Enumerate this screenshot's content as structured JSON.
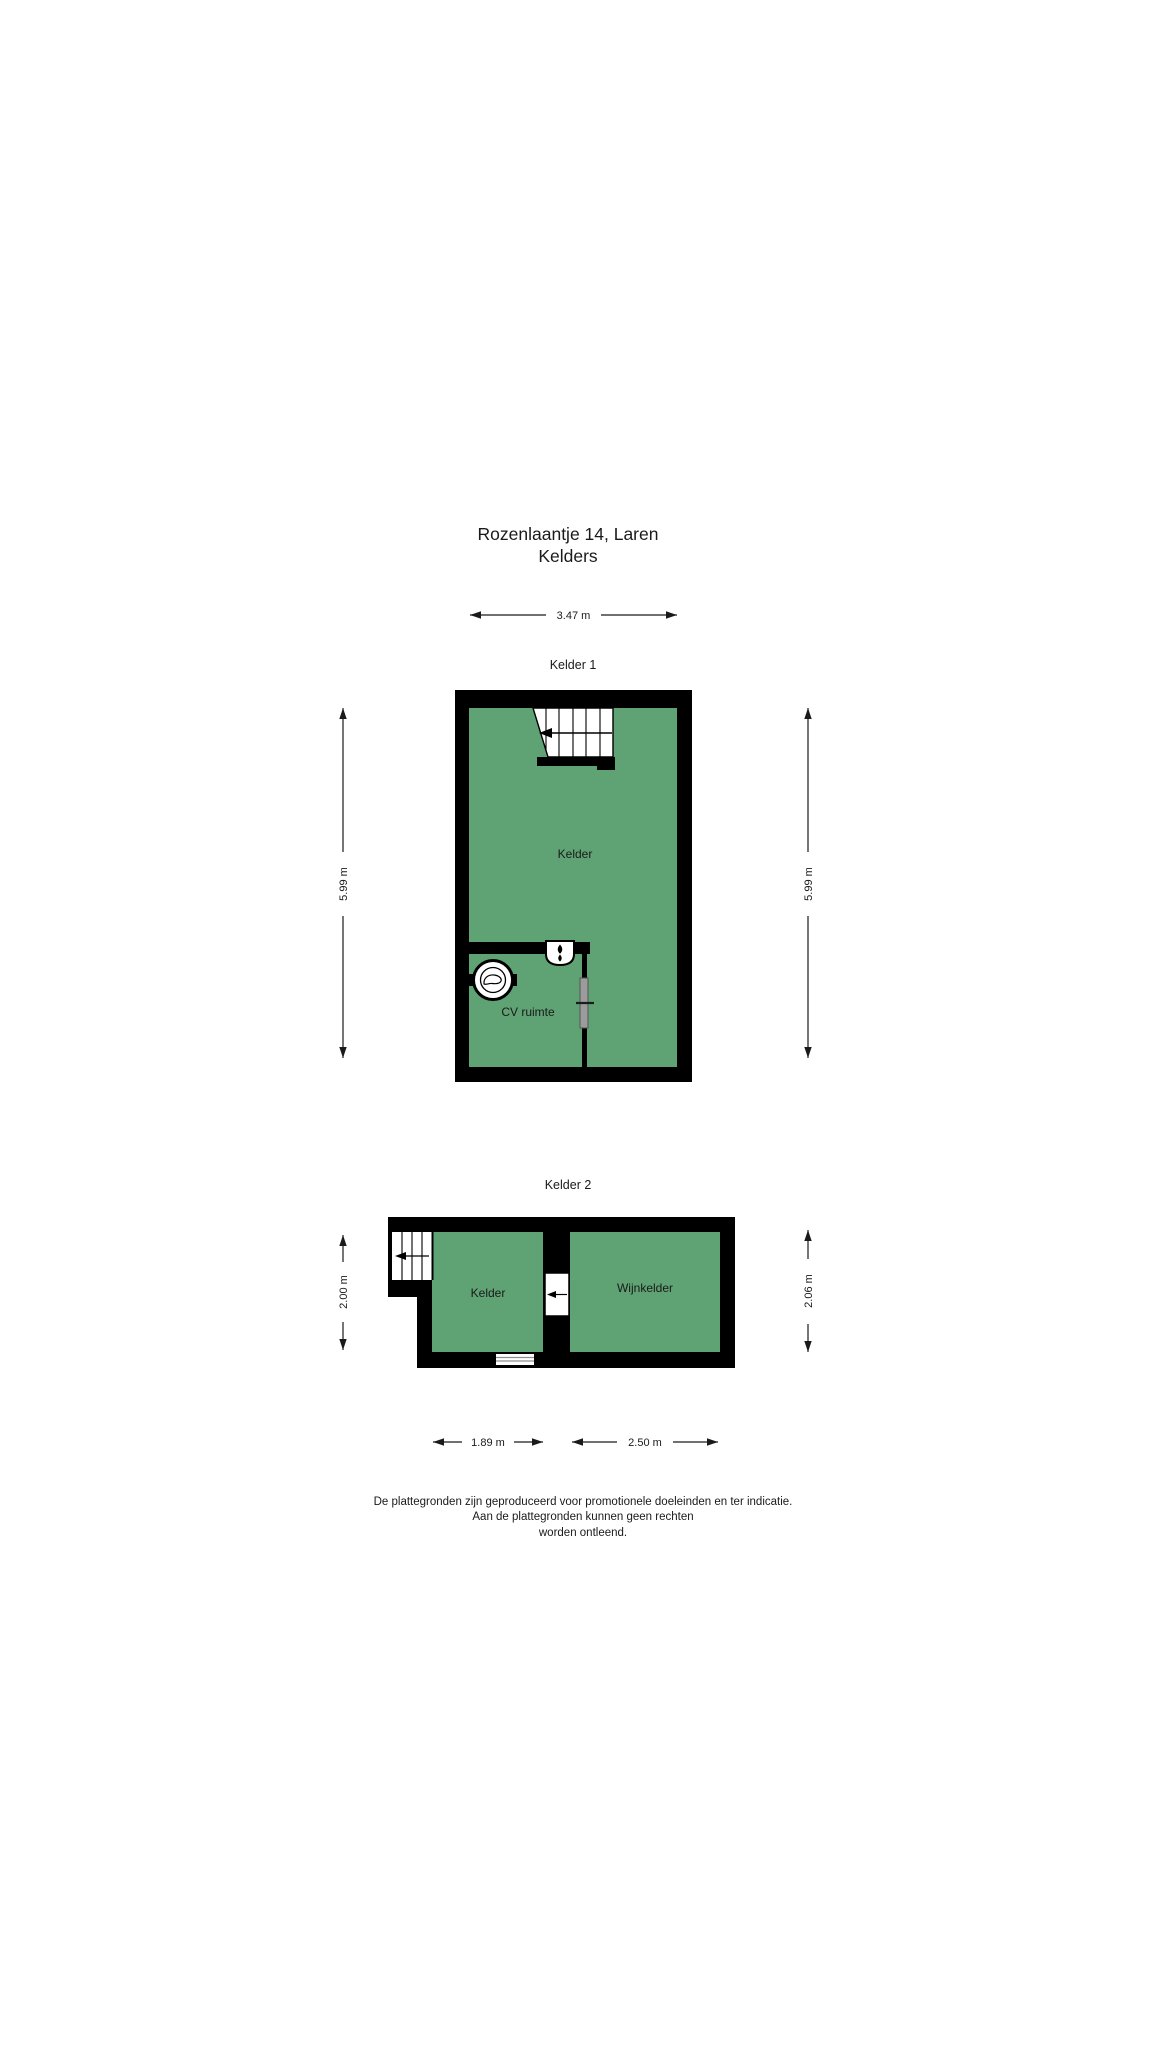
{
  "document": {
    "title_line1": "Rozenlaantje 14, Laren",
    "title_line2": "Kelders"
  },
  "plan1": {
    "name": "Kelder 1",
    "dim_top": "3.47 m",
    "dim_left": "5.99 m",
    "dim_right": "5.99 m",
    "room_main": "Kelder",
    "room_cv": "CV ruimte"
  },
  "plan2": {
    "name": "Kelder 2",
    "dim_left": "2.00 m",
    "dim_right": "2.06 m",
    "dim_bottom_left": "1.89 m",
    "dim_bottom_right": "2.50 m",
    "room_main": "Kelder",
    "room_wine": "Wijnkelder"
  },
  "disclaimer": {
    "line1": "De plattegronden zijn geproduceerd voor promotionele doeleinden en ter indicatie.",
    "line2": "Aan de plattegronden kunnen geen rechten",
    "line3": "worden ontleend."
  },
  "colors": {
    "floor_fill": "#5fa273",
    "wall": "#000000",
    "door_leaf": "#9b9b9b",
    "text": "#1a1a1a"
  }
}
